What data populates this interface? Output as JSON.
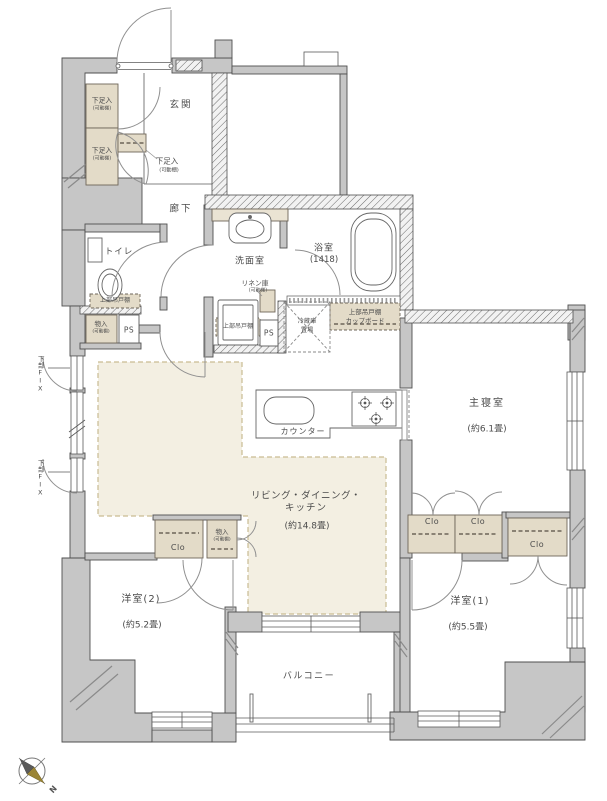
{
  "meta": {
    "type": "apartment-floor-plan"
  },
  "colors": {
    "wall": "#c6c6c6",
    "wall_line": "#4f4f4f",
    "cabinet_fill": "#e3dbc8",
    "ldk_floor": "#f3efe2",
    "text": "#4c4c4c",
    "compass_needle": "#9a8434"
  },
  "labels": {
    "entrance": "玄関",
    "hallway": "廊下",
    "toilet": "トイレ",
    "washroom": "洗面室",
    "bathroom": "浴室",
    "bathroom_size": "(1418)",
    "ldk_line1": "リビング・ダイニング・",
    "ldk_line2": "キッチン",
    "ldk_size": "(約14.8畳)",
    "master_bedroom": "主寝室",
    "master_bedroom_size": "(約6.1畳)",
    "bedroom1": "洋室(1)",
    "bedroom1_size": "(約5.5畳)",
    "bedroom2": "洋室(2)",
    "bedroom2_size": "(約5.2畳)",
    "balcony": "バルコニー",
    "counter": "カウンター",
    "shoe_cabinet": "下足入",
    "movable_shelf": "(可動棚)",
    "upper_cabinet": "上部吊戸棚",
    "cupboard_line1": "上部吊戸棚",
    "cupboard_line2": "カップボード",
    "storage": "物入",
    "linen_cabinet": "リネン庫",
    "fridge_line1": "冷蔵庫",
    "fridge_line2": "置場",
    "pipe_space": "PS",
    "closet": "Clo",
    "lower_fix": "下部FIX",
    "north_mark": "N"
  }
}
